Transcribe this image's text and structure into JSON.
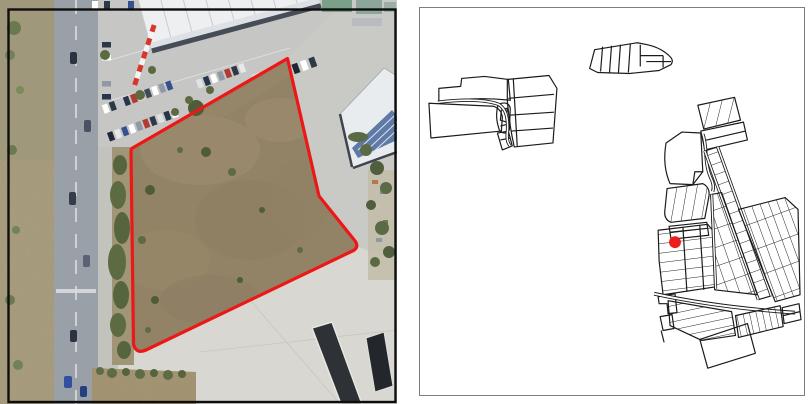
{
  "figure": {
    "type": "two-panel-location-figure",
    "left_panel": {
      "content": "aerial-photograph-of-vacant-parcel",
      "site_boundary_color": "#ee1717",
      "frame_color": "#0e0e0e"
    },
    "right_panel": {
      "content": "cadastral-parcel-map",
      "marker_color": "#ee1c1c",
      "parcel_line_color": "#1b1b1b",
      "border_color": "#7e7e7e",
      "background_color": "#ffffff"
    }
  }
}
